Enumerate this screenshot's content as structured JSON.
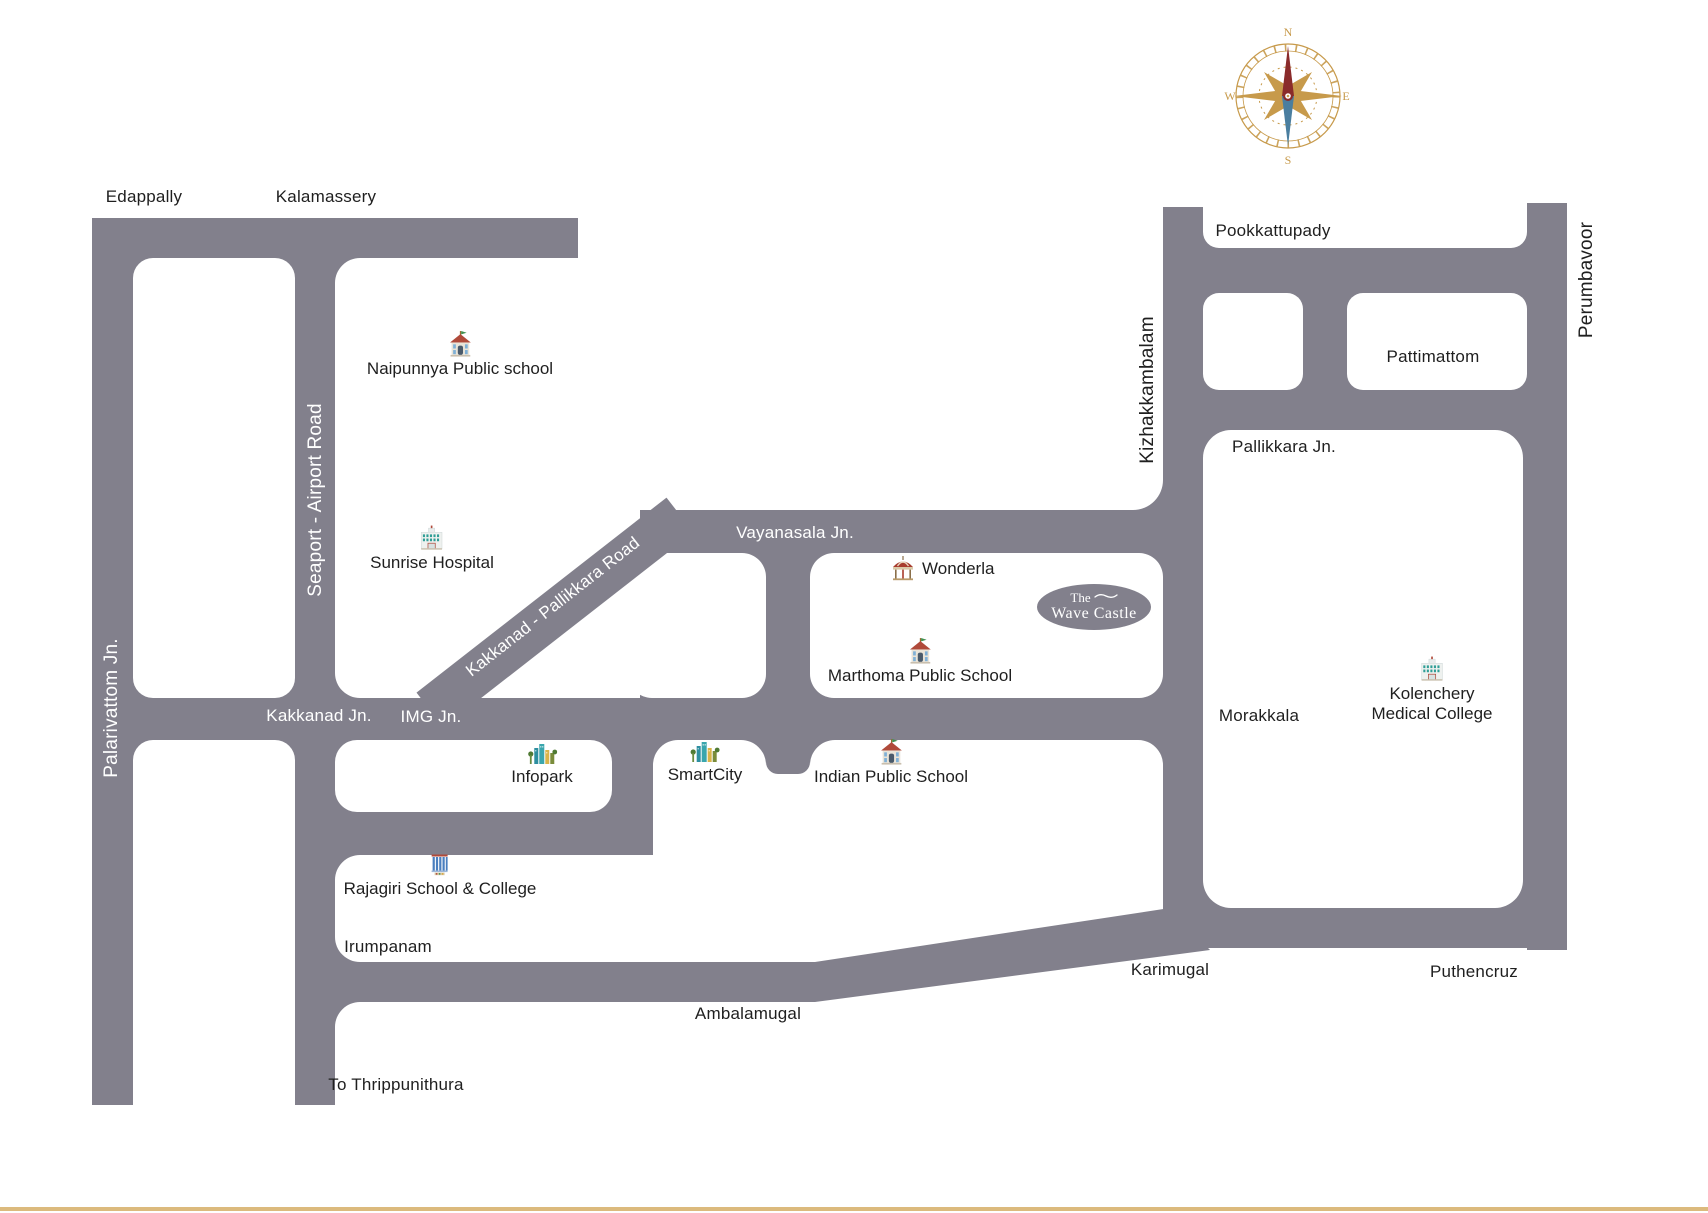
{
  "colors": {
    "road": "#82808C",
    "accent_line": "#DCBA7D",
    "compass_gold": "#C79A4B",
    "needle_red": "#8A2B2B",
    "needle_blue": "#4A7E9F"
  },
  "compass": {
    "n": "N",
    "e": "E",
    "s": "S",
    "w": "W"
  },
  "logo": {
    "line1": "The",
    "line2": "Wave Castle"
  },
  "towns": {
    "edappally": "Edappally",
    "kalamassery": "Kalamassery",
    "pookkattupady": "Pookkattupady",
    "pattimattom": "Pattimattom",
    "pallikkara_jn": "Pallikkara Jn.",
    "morakkala": "Morakkala",
    "irumpanam": "Irumpanam",
    "ambalamugal": "Ambalamugal",
    "karimugal": "Karimugal",
    "puthencruz": "Puthencruz",
    "to_thrippunithura": "To Thrippunithura"
  },
  "road_labels": {
    "palarivattom": "Palarivattom Jn.",
    "seaport": "Seaport - Airport Road",
    "kakkanad_pallikkara": "Kakkanad - Pallikkara Road",
    "vayanasala": "Vayanasala Jn.",
    "kakkanad_jn": "Kakkanad Jn.",
    "img_jn": "IMG Jn.",
    "kizhakkambalam": "Kizhakkambalam",
    "perumbavoor": "Perumbavoor"
  },
  "landmarks": {
    "naipunnya": {
      "label": "Naipunnya Public school",
      "icon": "school-icon"
    },
    "sunrise": {
      "label": "Sunrise Hospital",
      "icon": "hospital-icon"
    },
    "wonderla": {
      "label": "Wonderla",
      "icon": "carousel-icon"
    },
    "marthoma": {
      "label": "Marthoma Public School",
      "icon": "school-icon"
    },
    "infopark": {
      "label": "Infopark",
      "icon": "skyline-icon"
    },
    "smartcity": {
      "label": "SmartCity",
      "icon": "skyline-icon"
    },
    "indian_public": {
      "label": "Indian Public School",
      "icon": "school-icon"
    },
    "rajagiri": {
      "label": "Rajagiri School & College",
      "icon": "college-icon"
    },
    "kolenchery": {
      "label_line1": "Kolenchery",
      "label_line2": "Medical College",
      "icon": "hospital-icon"
    }
  }
}
